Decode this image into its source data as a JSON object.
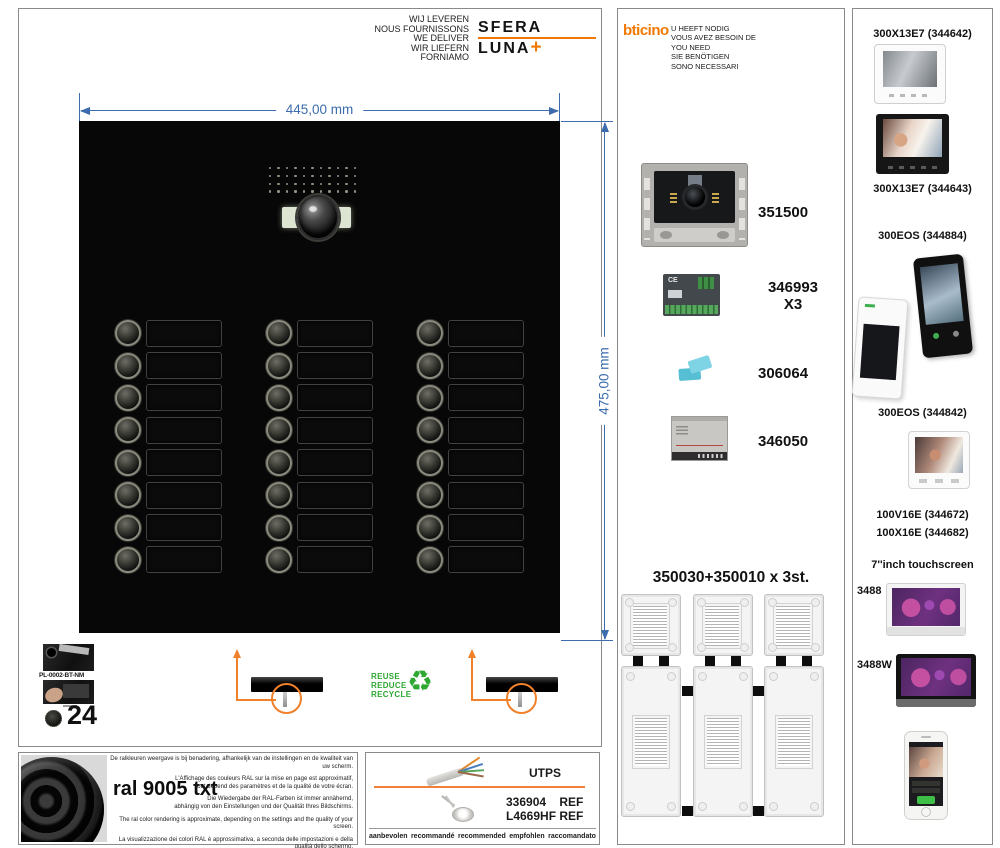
{
  "header": {
    "deliver_lines": [
      "WIJ LEVEREN",
      "NOUS FOURNISSONS",
      "WE DELIVER",
      "WIR LIEFERN",
      "FORNIAMO"
    ],
    "sfera_logo_text": "SFERA LUNA",
    "sfera_logo_plus": "+"
  },
  "need_box": {
    "bticino_logo": "bticino",
    "need_lines": [
      "U HEEFT NODIG",
      "VOUS AVEZ BESOIN DE",
      "YOU NEED",
      "SIE BENÖTIGEN",
      "SONO NECESSARI"
    ],
    "products": [
      {
        "ref": "351500",
        "qty": ""
      },
      {
        "ref": "346993",
        "qty": "X3"
      },
      {
        "ref": "306064",
        "qty": ""
      },
      {
        "ref": "346050",
        "qty": ""
      }
    ],
    "boxes_title": "350030+350010 x 3st."
  },
  "panel": {
    "width_label": "445,00 mm",
    "height_label": "475,00 mm",
    "button_rows": 8,
    "button_columns": 3
  },
  "mounting": {
    "plate_ref": "PL-0002-BT-NM",
    "screws_count": "24",
    "recycle_lines": [
      "REUSE",
      "REDUCE",
      "RECYCLE"
    ],
    "recycle_icon": "♻"
  },
  "right_box": {
    "items": [
      "300X13E7 (344642)",
      "300X13E7 (344643)",
      "300EOS (344884)",
      "300EOS (344842)",
      "100V16E (344672)",
      "100X16E (344682)",
      "7''inch touchscreen",
      "3488",
      "3488W"
    ]
  },
  "ral_box": {
    "title": "ral 9005 txt",
    "disclaimer_nl": "De ralkleuren weergave is bij benadering, afhankelijk van de instellingen en de kwaliteit van uw scherm.",
    "disclaimer_fr": [
      "L'Affichage des couleurs RAL sur la mise en page est approximatif,",
      "tout dépend des paramètres et de la qualité de votre écran."
    ],
    "disclaimer_de": [
      "Die Wiedergabe der RAL-Farben ist immer annähernd,",
      "abhängig von den Einstellungen und der Qualität Ihres Bildschirms."
    ],
    "disclaimer_en": "The ral color rendering is approximate, depending on the settings and the quality of your screen.",
    "disclaimer_it": "La visualizzazione dei colori RAL è approssimativa, a seconda delle impostazioni e della qualità dello schermo."
  },
  "cable_box": {
    "utps_label": "UTPS",
    "ref_line1": "336904    REF",
    "ref_line2": "L4669HF REF",
    "recommend_words": [
      "aanbevolen",
      "recommandé",
      "recommended",
      "empfohlen",
      "raccomandato"
    ]
  },
  "colors": {
    "accent_orange": "#f07800",
    "dimension_blue": "#3c6cae",
    "recycle_green": "#2fa832",
    "panel_black": "#070707"
  }
}
